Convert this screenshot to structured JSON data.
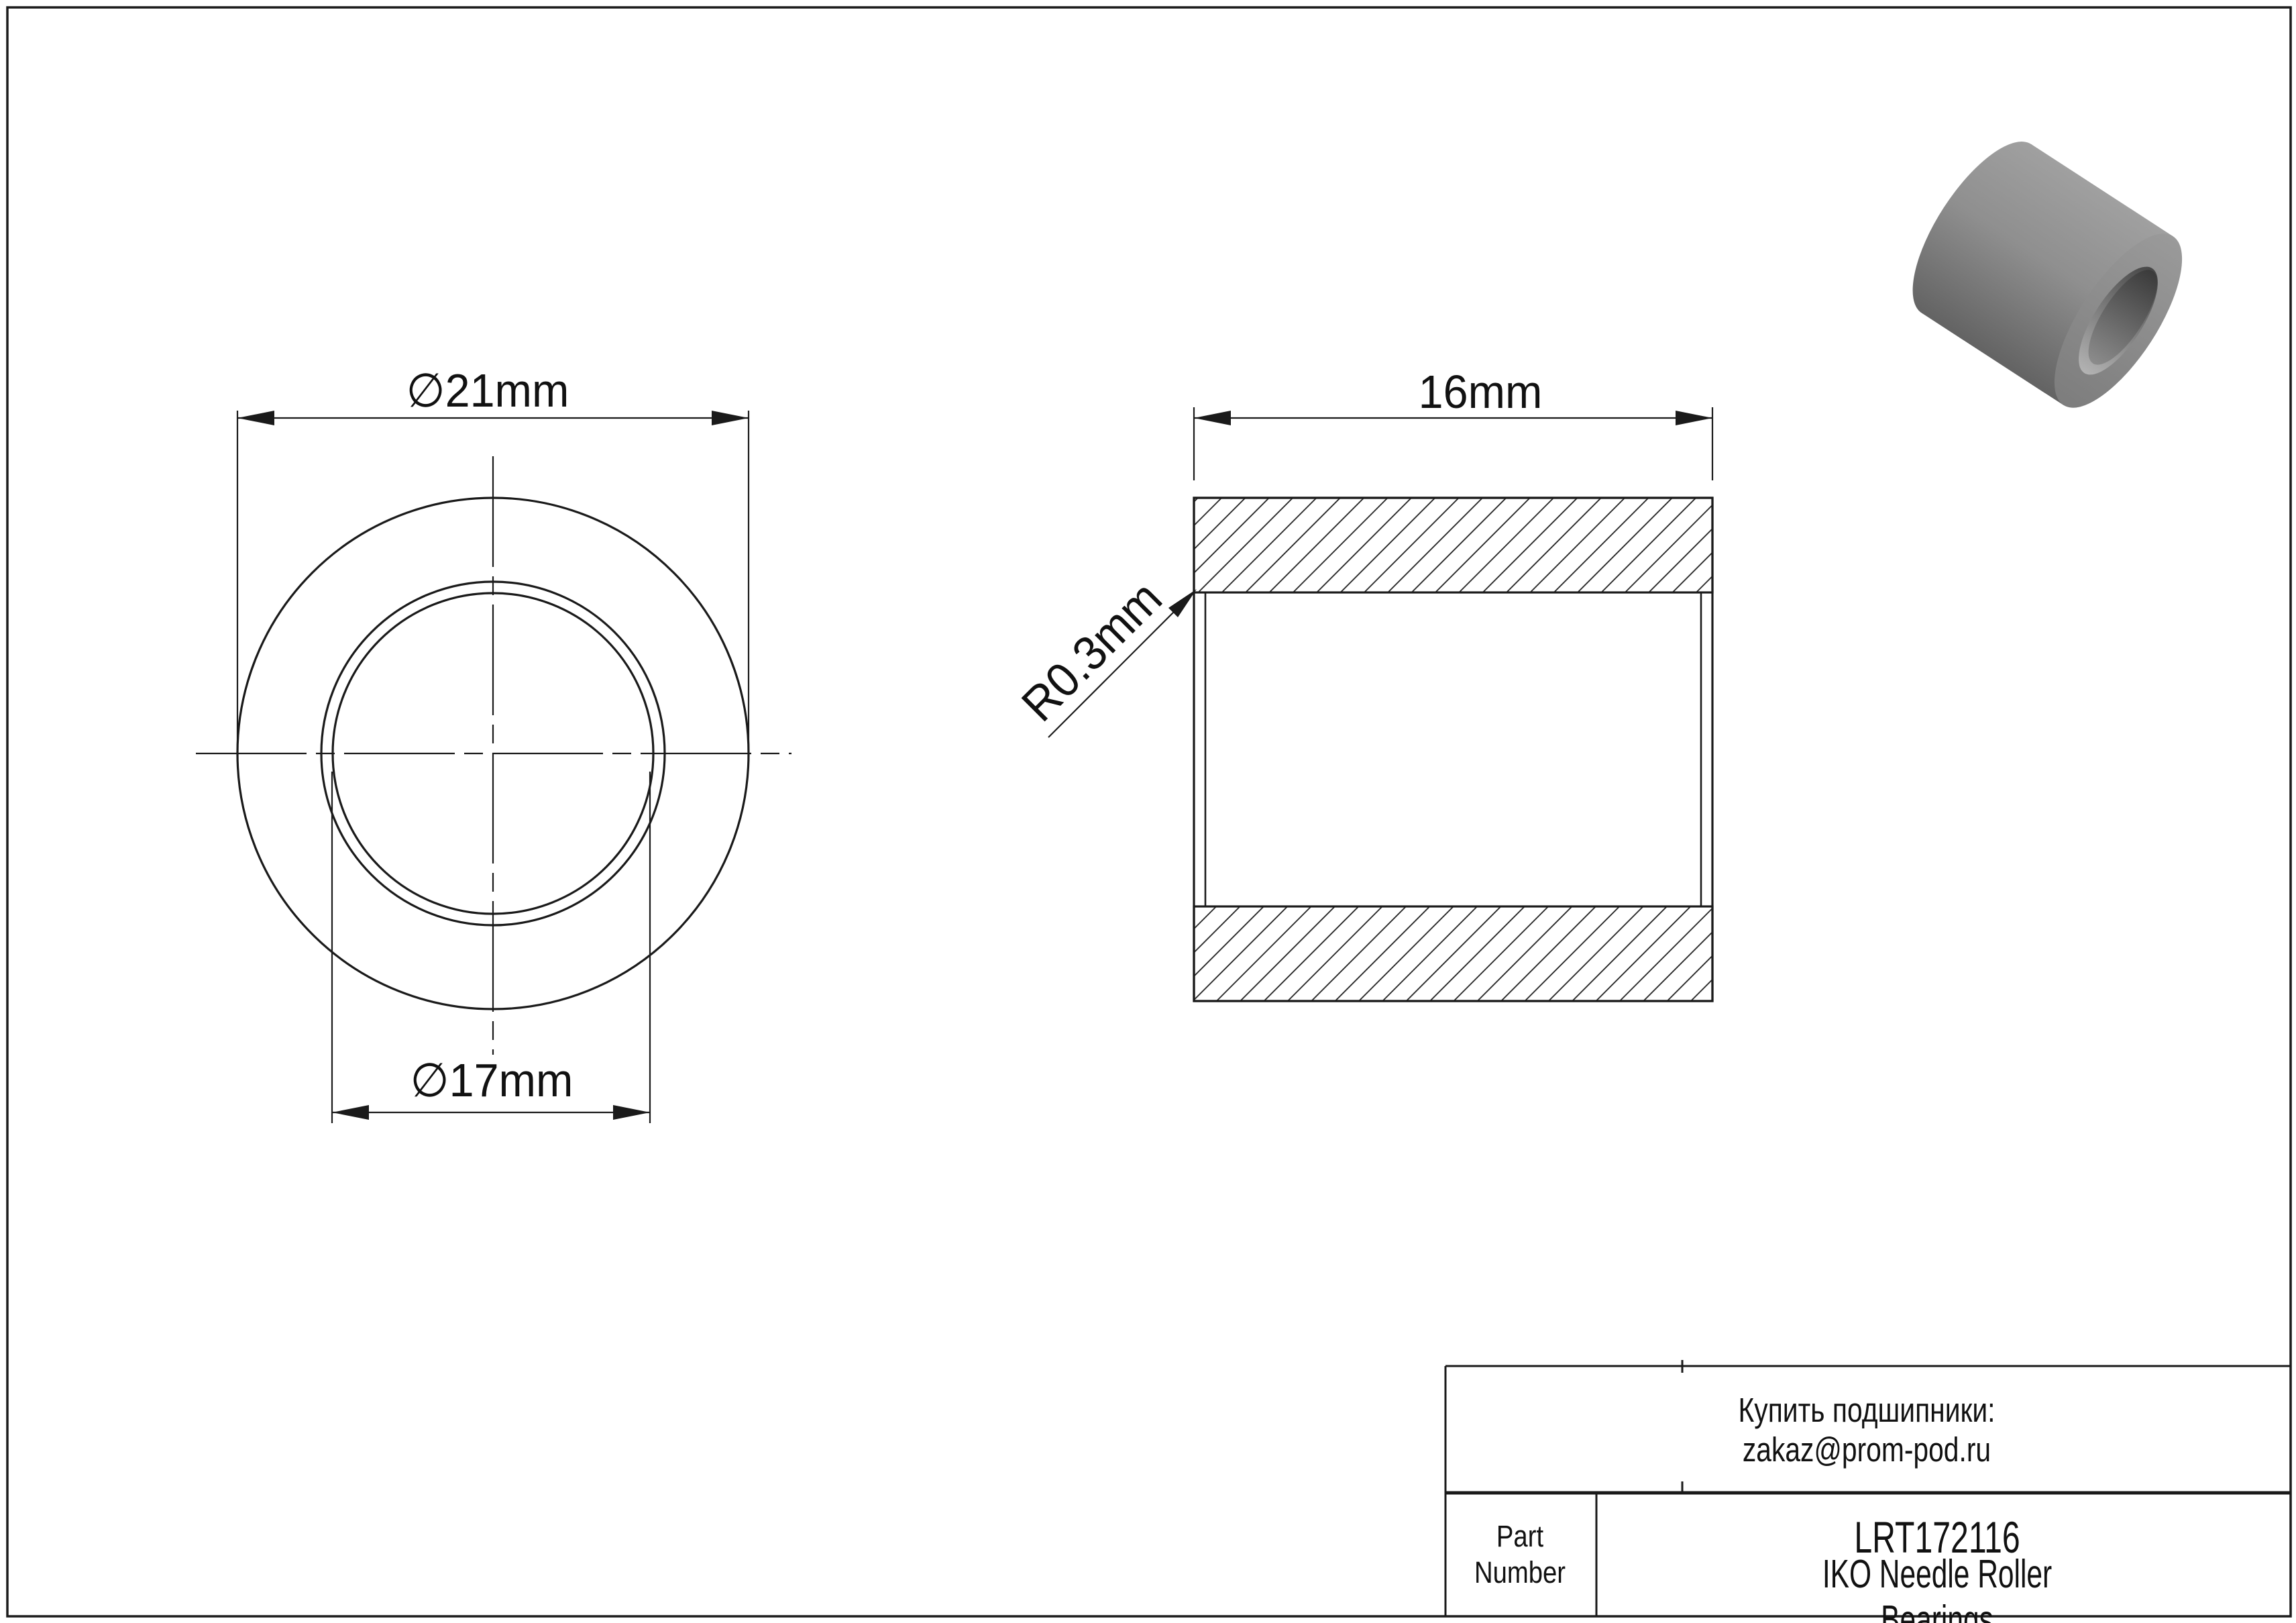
{
  "page": {
    "background": "#ffffff",
    "line_color": "#1a1a1a"
  },
  "front_view": {
    "outer_diameter_label": "∅21mm",
    "bore_diameter_label": "∅17mm"
  },
  "section_view": {
    "width_label": "16mm",
    "fillet_radius_label": "R0.3mm"
  },
  "title_block": {
    "contact_note": "Купить подшипники: zakaz@prom-pod.ru",
    "part_number_label": "Part\nNumber",
    "part_number": "LRT172116",
    "brand_line": "IKO Needle Roller Bearings"
  },
  "render": {
    "body_light": "#a0a0a0",
    "body_mid": "#8f8f8f",
    "body_dark": "#636363",
    "face_light": "#9a9a9a",
    "face_dark": "#7d7d7d",
    "bore_dark": "#474747",
    "bore_light": "#b3b3b3",
    "bore_deep": "#3a3a3a",
    "bore_deep_light": "#8e8e8e"
  }
}
